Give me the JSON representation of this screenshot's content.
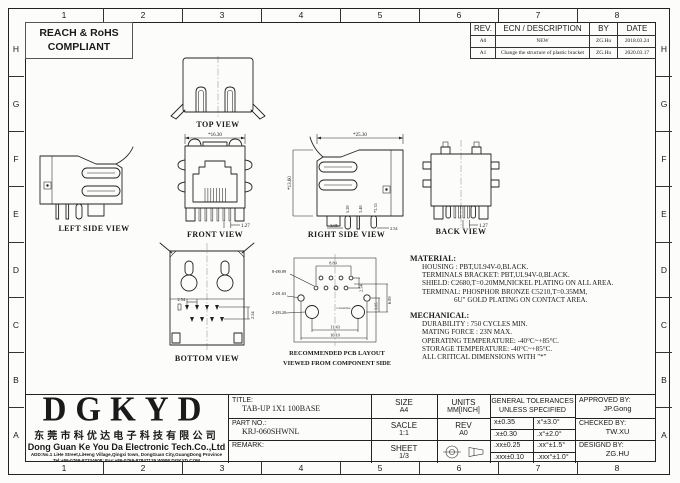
{
  "sheet": {
    "grid_numbers": [
      "1",
      "2",
      "3",
      "4",
      "5",
      "6",
      "7",
      "8"
    ],
    "grid_letters": [
      "H",
      "G",
      "F",
      "E",
      "D",
      "C",
      "B",
      "A"
    ]
  },
  "compliance": {
    "line1": "REACH & RoHS",
    "line2": "COMPLIANT"
  },
  "revision_table": {
    "headers": {
      "rev": "REV.",
      "description": "ECN / DESCRIPTION",
      "by": "BY",
      "date": "DATE"
    },
    "rows": [
      {
        "rev": "A0",
        "description": "NEW",
        "by": "ZG.Hu",
        "date": "2018.03.24"
      },
      {
        "rev": "A1",
        "description": "Change the structure of plastic bracket",
        "by": "ZG.Hu",
        "date": "2020.03.17"
      }
    ]
  },
  "views": {
    "top": {
      "label": "TOP VIEW"
    },
    "left_side": {
      "label": "LEFT SIDE VIEW"
    },
    "front": {
      "label": "FRONT VIEW",
      "dim_width": "*16.30",
      "dim_pitch": "1.27"
    },
    "right_side": {
      "label": "RIGHT SIDE VIEW",
      "dim_depth": "*25.30",
      "dim_height": "*13.60",
      "dim_pin1": "5.28",
      "dim_pin2": "3.48",
      "dim_pin3": "*3.35",
      "dim_a": "3.05",
      "dim_b": "(0.74",
      "dim_c": "8.89",
      "dim_d": "2.54"
    },
    "back": {
      "label": "BACK VIEW",
      "dim_pitch": "1.27"
    },
    "bottom": {
      "label": "BOTTOM VIEW",
      "dim_row": "2.54",
      "dim_col": "2.54"
    },
    "pcb": {
      "label_line1": "RECOMMENDED PCB LAYOUT",
      "label_line2": "VIEWED FROM COMPONENT SIDE",
      "callout_pins": "8-Ø0.89",
      "callout_shield": "2-Ø1.63",
      "callout_posts": "2-Ø3.20",
      "dim_span": "8.89",
      "dim_stagger": "2.54",
      "dim_right_a": "6.89",
      "dim_right_b": "3.05",
      "dim_posts": "11.43",
      "dim_overall": "16.10",
      "centerline": "Centerline"
    }
  },
  "notes": {
    "material_heading": "MATERIAL:",
    "material_lines": [
      "HOUSING : PBT,UL94V-0,BLACK.",
      "TERMINALS BRACKET: PBT,UL94V-0,BLACK.",
      "SHIELD: C2680,T=0.20MM,NICKEL PLATING ON ALL AREA.",
      "TERMINAL: PHOSPHOR BRONZE C5210,T=0.35MM,",
      "6U\" GOLD PLATING ON CONTACT AREA."
    ],
    "mechanical_heading": "MECHANICAL:",
    "mechanical_lines": [
      "DURABILITY : 750 CYCLES MIN.",
      "MATING FORCE : 23N MAX.",
      "OPERATING TEMPERATURE: -40°C~+85°C.",
      "STORAGE TEMPERATURE: -40°C~+85°C.",
      "ALL CRITICAL DIMENSIONS WITH \"*\""
    ]
  },
  "company": {
    "logo": "DGKYD",
    "name_cn": "东莞市科优达电子科技有限公司",
    "name_en": "Dong Guan Ke You Da Electronic Tech.Co.,Ltd",
    "address": "ADD:No.1 LiHe Street,LiHeng Village,Qingxi town, DongGuan City,GuangDong Province",
    "contact": "Tel:+86-0769-87334608; Fax:+86-0769-87847129 WWW.DGKYD.COM"
  },
  "title_block": {
    "title_label": "TITLE:",
    "title_value": "TAB-UP 1X1 100BASE",
    "part_label": "PART NO.:",
    "part_value": "KRJ-060SHWNL",
    "remark_label": "REMARK:",
    "size_label": "SIZE",
    "size_value": "A4",
    "scale_label": "SACLE",
    "scale_value": "1:1",
    "sheet_label": "SHEET",
    "sheet_value": "1/3",
    "units_label": "UNITS",
    "units_value": "MM[INCH]",
    "rev_label": "REV",
    "rev_value": "A0",
    "tolerance_heading_line1": "GENERAL TOLERANCES",
    "tolerance_heading_line2": "UNLESS SPECIFIED",
    "tolerance_rows": [
      {
        "linear": "x±0.35",
        "angular": "x°±3.0°"
      },
      {
        "linear": ".x±0.30",
        "angular": ".x°±2.0°"
      },
      {
        "linear": ".xx±0.25",
        "angular": ".xx°±1.5°"
      },
      {
        "linear": ".xxx±0.10",
        "angular": ".xxx°±1.0°"
      }
    ],
    "approved_label": "APPROVED BY:",
    "approved_value": "JP.Gong",
    "checked_label": "CHECKED BY:",
    "checked_value": "TW.XU",
    "designed_label": "DESIGND BY:",
    "designed_value": "ZG.HU"
  }
}
